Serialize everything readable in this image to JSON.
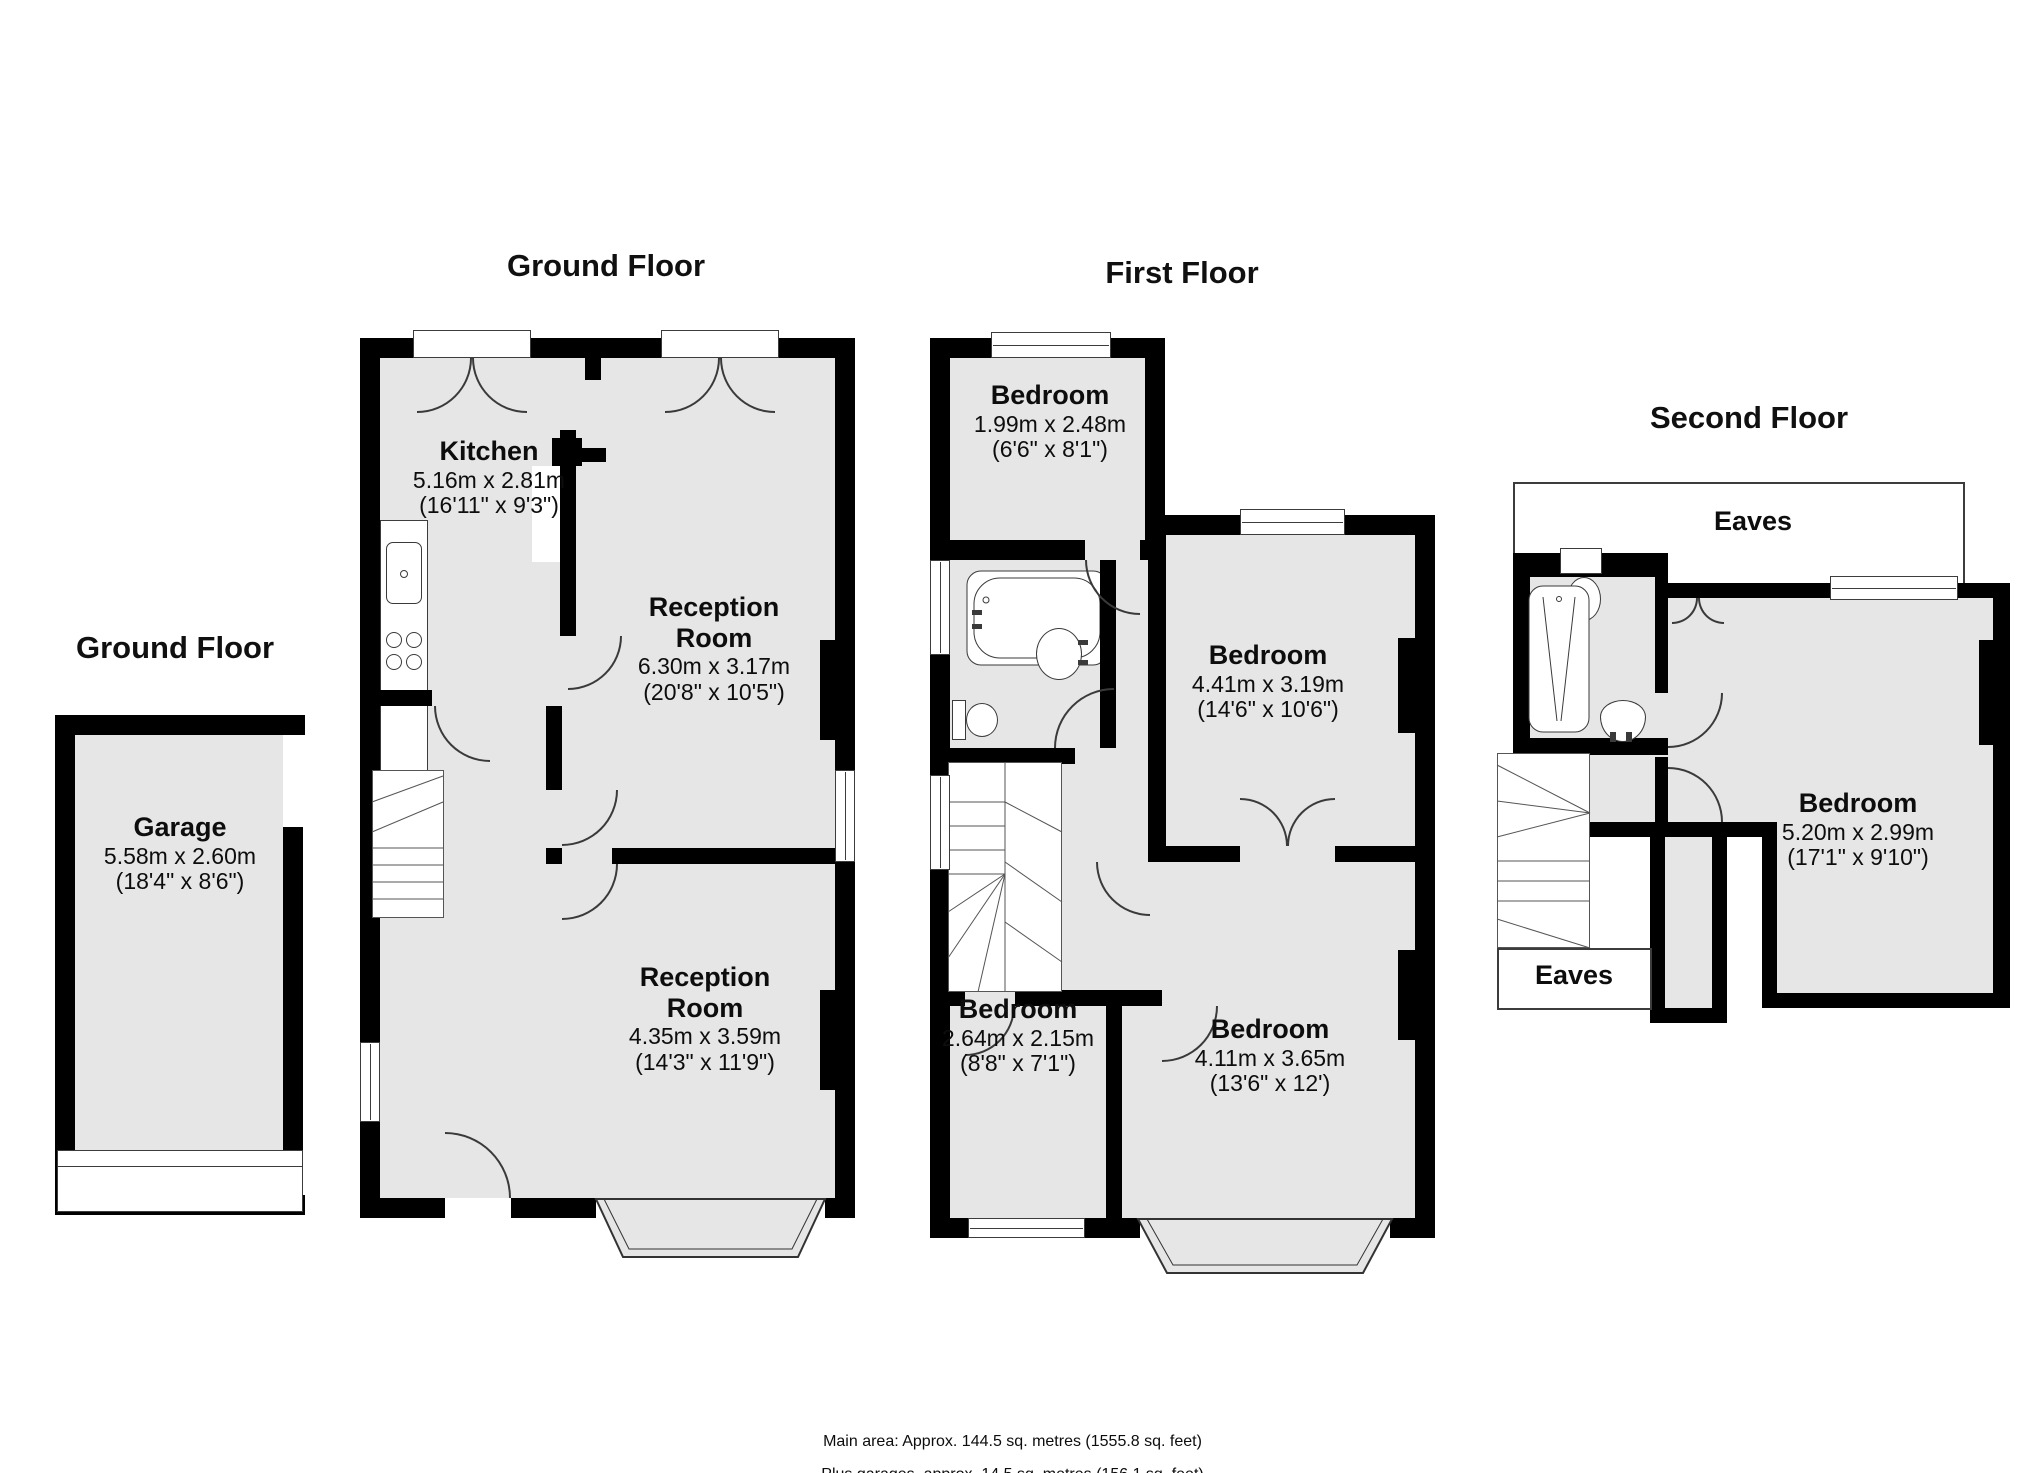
{
  "colors": {
    "wall": "#000000",
    "room_fill": "#e6e6e6",
    "line": "#3a3a3a",
    "background": "#ffffff"
  },
  "floors": {
    "ground_garage": {
      "title": "Ground Floor"
    },
    "ground_main": {
      "title": "Ground Floor"
    },
    "first": {
      "title": "First Floor"
    },
    "second": {
      "title": "Second Floor"
    }
  },
  "rooms": {
    "garage": {
      "name": "Garage",
      "metric": "5.58m x 2.60m",
      "imperial": "(18'4\" x 8'6\")"
    },
    "kitchen": {
      "name": "Kitchen",
      "metric": "5.16m x 2.81m",
      "imperial": "(16'11\" x 9'3\")"
    },
    "reception1": {
      "name": "Reception Room",
      "metric": "6.30m x 3.17m",
      "imperial": "(20'8\" x 10'5\")"
    },
    "reception2": {
      "name": "Reception Room",
      "metric": "4.35m x 3.59m",
      "imperial": "(14'3\" x 11'9\")"
    },
    "ff_bedroom_small": {
      "name": "Bedroom",
      "metric": "1.99m x 2.48m",
      "imperial": "(6'6\" x 8'1\")"
    },
    "ff_bedroom_right": {
      "name": "Bedroom",
      "metric": "4.41m x 3.19m",
      "imperial": "(14'6\" x 10'6\")"
    },
    "ff_bedroom_bottom_left": {
      "name": "Bedroom",
      "metric": "2.64m x 2.15m",
      "imperial": "(8'8\" x 7'1\")"
    },
    "ff_bedroom_bottom_right": {
      "name": "Bedroom",
      "metric": "4.11m x 3.65m",
      "imperial": "(13'6\" x 12')"
    },
    "sf_bedroom": {
      "name": "Bedroom",
      "metric": "5.20m x 2.99m",
      "imperial": "(17'1\" x 9'10\")"
    },
    "eaves_top": {
      "name": "Eaves"
    },
    "eaves_bottom": {
      "name": "Eaves"
    }
  },
  "footer": {
    "main": "Main area: Approx. 144.5 sq. metres (1555.8 sq. feet)",
    "sub": "Plus garages, approx. 14.5 sq. metres (156.1 sq. feet)"
  }
}
